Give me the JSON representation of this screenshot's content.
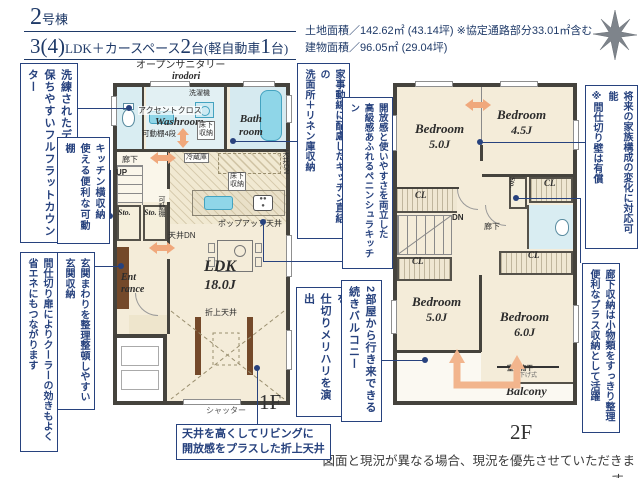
{
  "header": {
    "building_no": "2",
    "building_suffix": "号棟",
    "plan_big1": "3(4)",
    "plan_small1": "LDK＋カースペース",
    "plan_big2": "2",
    "plan_small2": "台(軽自動車",
    "plan_big3": "1",
    "plan_small3": "台)",
    "land_area": "土地面積／142.62㎡ (43.14坪) ※協定通路部分33.01㎡含む",
    "building_area": "建物面積／96.05㎡ (29.04坪)"
  },
  "callouts": {
    "full_flat_counter": "洗練されたデザイン＋清潔感を\n保ちやすいフルフラットカウンター",
    "kitchen_side_storage": "キッチン横収納\n使える便利な可動棚",
    "entrance_storage": "玄関まわりを整理整頓しやすい\n玄関収納",
    "partition_door": "間仕切り扉によりクーラーの効きもよく\n省エネにもつながります",
    "linen_storage": "家事動線に配慮したキッチン直結の\n洗面所＋リネン庫収納",
    "peninsula_kitchen": "開放感と使いやすさを両立した\n高級感あふれるペニンシュラキッチン",
    "ceiling_design": "天井デザインで空間を\n仕切りメリハリを演出",
    "balcony_access": "2部屋から行き来できる\n続きバルコニー",
    "future_partition": "将来の家族構成の変化に対応可能\n※間仕切り壁は有償",
    "hallway_storage": "廊下収納は小物類をすっきり整理\n便利なプラス収納として活躍",
    "oriage_ceiling": "天井を高くしてリビングに\n開放感をプラスした折上天井"
  },
  "plan1f": {
    "open_sanitary": "オープンサニタリー",
    "open_sanitary_sub": "irodori",
    "accent_cross": "アクセントクロス",
    "washroom": "Washroom",
    "movable_shelf4": "可動棚4段",
    "washer": "洗濯機",
    "underfloor": "床下\n収納",
    "bathroom": "Bath\nroom",
    "fridge": "冷蔵庫",
    "ceiling_dn_v": "天井DN",
    "hallway": "廊下",
    "up": "UP",
    "sto": "Sto.",
    "movable_shelf": "可動棚",
    "ceiling_dn": "天井DN",
    "popup_ceiling": "ポップアップ天井",
    "ldk": "LDK",
    "ldk_size": "18.0J",
    "entrance": "Ent\nrance",
    "oriage": "折上天井",
    "shutter": "シャッター",
    "floor_label": "1F"
  },
  "plan2f": {
    "bedroom": "Bedroom",
    "b1_size": "5.0J",
    "b2_size": "4.5J",
    "b3_size": "5.0J",
    "b4_size": "6.0J",
    "cl": "CL",
    "sto": "Sto.",
    "dn": "DN",
    "hallway": "廊下",
    "monohoshi": "室内物干",
    "monohoshi_sub": "吊下げ式",
    "balcony": "Balcony",
    "floor_label": "2F"
  },
  "footer": {
    "disclaimer": "図面と現況が異なる場合、現況を優先させていただきます。"
  },
  "colors": {
    "accent_navy": "#27427e",
    "header_navy": "#1f3a68",
    "floor_beige": "#f4ecd9",
    "water_cyan": "#8fd6e8",
    "wall_dark": "#45433d",
    "arrow_orange": "#f0a87c"
  }
}
